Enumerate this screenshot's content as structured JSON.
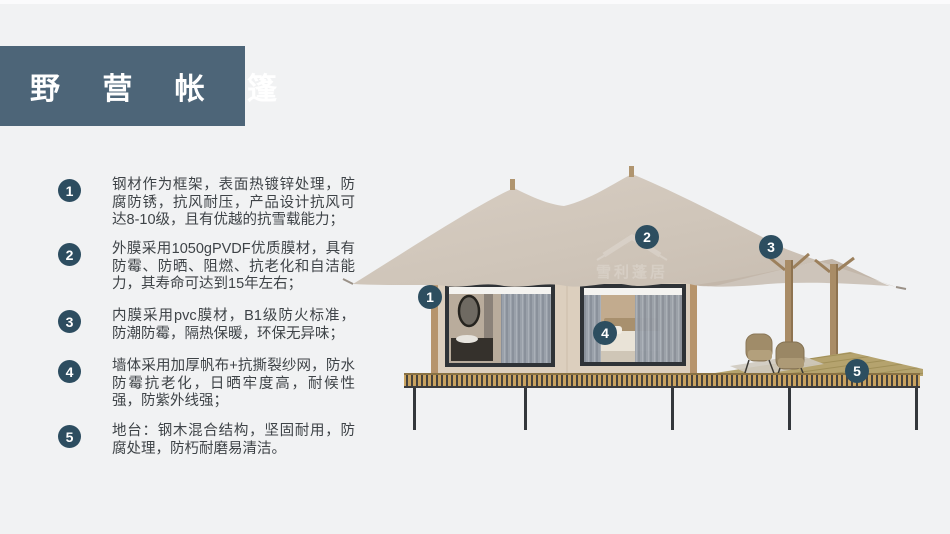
{
  "slide": {
    "background": "#f1f2f3",
    "accent": "#4d6578"
  },
  "title": {
    "text": "野 营 帐 篷"
  },
  "features": [
    {
      "num": "1",
      "text": "钢材作为框架，表面热镀锌处理，防腐防锈，抗风耐压，产品设计抗风可达8-10级，且有优越的抗雪载能力；"
    },
    {
      "num": "2",
      "text": "外膜采用1050gPVDF优质膜材，具有防霉、防晒、阻燃、抗老化和自洁能力，其寿命可达到15年左右；"
    },
    {
      "num": "3",
      "text": "内膜采用pvc膜材，B1级防火标准，防潮防霉，隔热保暖，环保无异味；"
    },
    {
      "num": "4",
      "text": "墙体采用加厚帆布+抗撕裂纱网，防水防霉抗老化，日晒牢度高，耐候性强，防紫外线强；"
    },
    {
      "num": "5",
      "text": "地台：钢木混合结构，坚固耐用，防腐处理，防朽耐磨易清洁。"
    }
  ],
  "diagram": {
    "markers": [
      {
        "label": "1"
      },
      {
        "label": "2"
      },
      {
        "label": "3"
      },
      {
        "label": "4"
      },
      {
        "label": "5"
      }
    ],
    "watermark": "雪利蓬居",
    "colors": {
      "marker": "#2d4e60",
      "canopy": "#d0c6ba",
      "cabin_wall": "#dccfbe",
      "wood_trim": "#b6946c",
      "deck_stripe_tan": "#c9a360",
      "deck_stripe_dark": "#46423c",
      "window_frame": "#2f3337",
      "leg": "#33373b",
      "title_bg": "#4d6578"
    }
  }
}
